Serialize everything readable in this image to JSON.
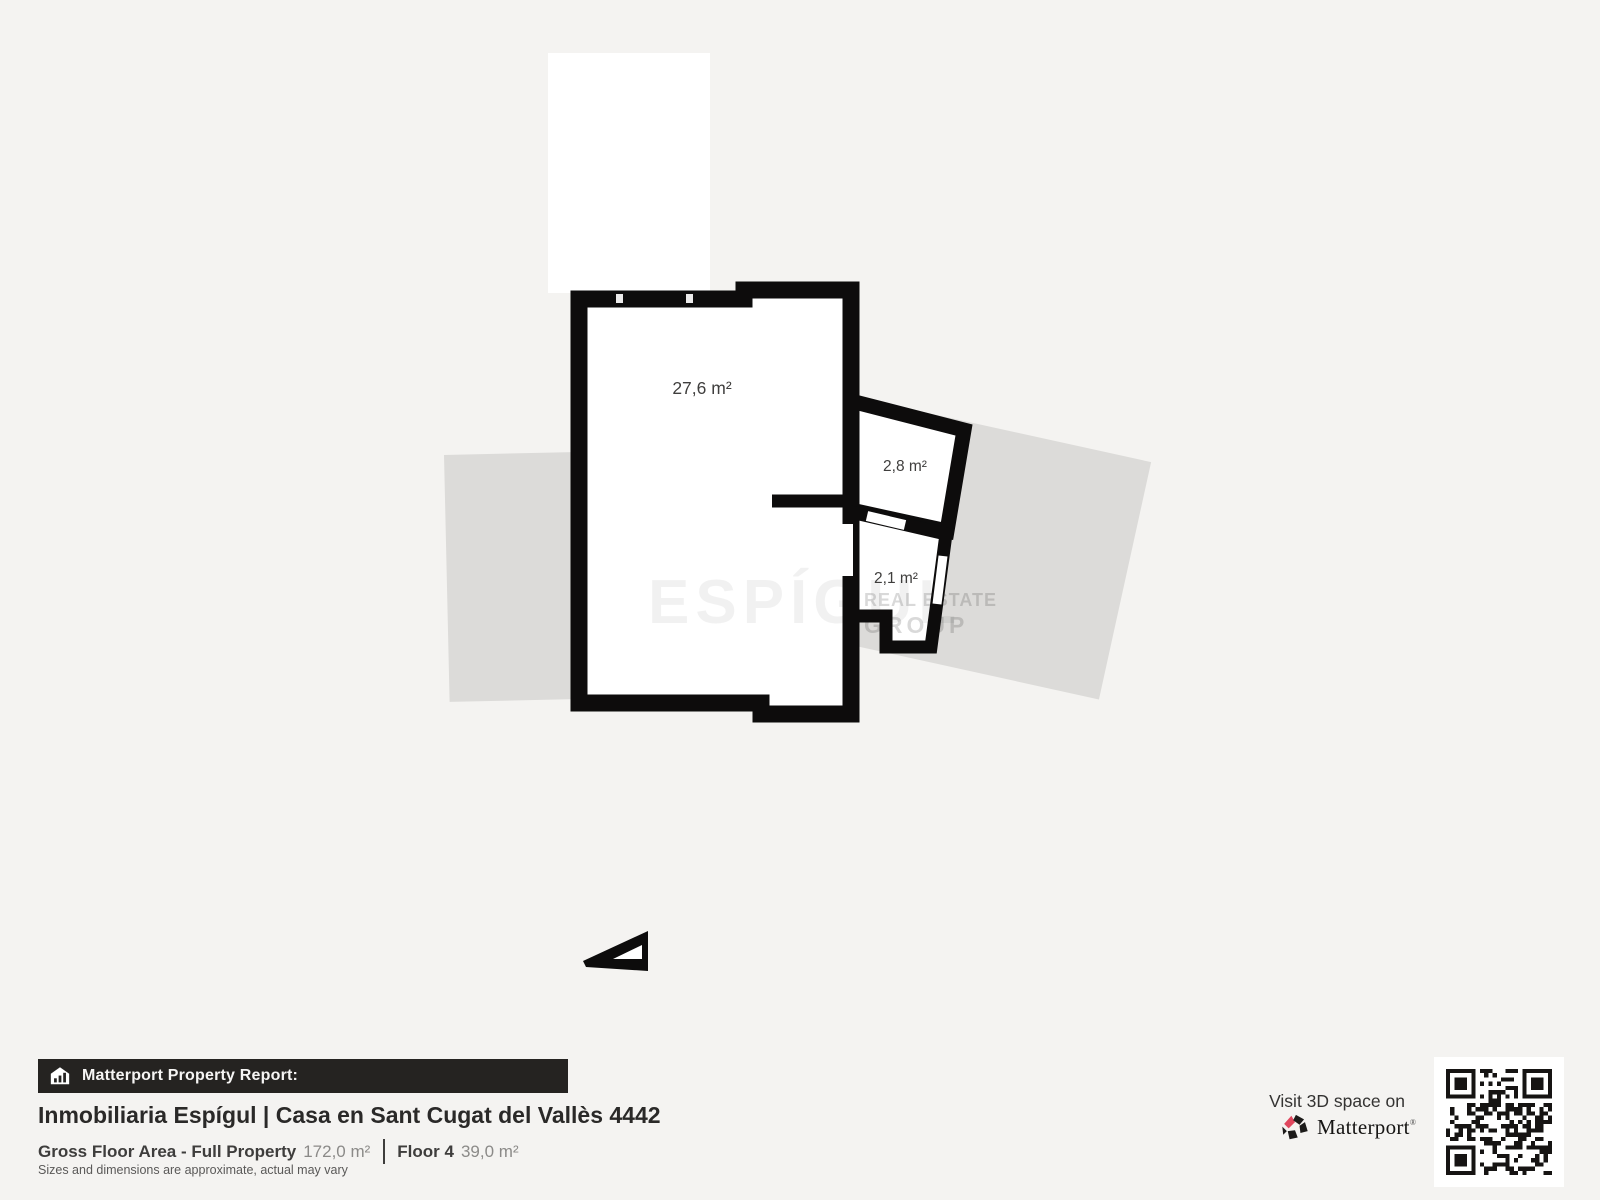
{
  "plan": {
    "rooms": [
      {
        "area_label": "27,6 m²"
      },
      {
        "area_label": "2,8 m²"
      },
      {
        "area_label": "2,1 m²"
      }
    ],
    "watermark": {
      "brand": "ESPÍGUL",
      "sub1": "REAL ESTATE",
      "sub2": "GROUP"
    }
  },
  "footer": {
    "badge": "Matterport Property Report:",
    "title": "Inmobiliaria Espígul | Casa en Sant Cugat del Vallès 4442",
    "stats": {
      "area_label": "Gross Floor Area - Full Property",
      "area_value": "172,0 m²",
      "floor_label": "Floor 4",
      "floor_value": "39,0 m²"
    },
    "disclaimer": "Sizes and dimensions are approximate, actual may vary",
    "cta": {
      "text": "Visit 3D space on",
      "brand": "Matterport",
      "mark": "®"
    }
  },
  "colors": {
    "background": "#f4f3f1",
    "walls": "#0d0c0c",
    "muted_area": "#dcdbd9",
    "footer_bar": "#252321",
    "brand_pink": "#e0475e"
  }
}
